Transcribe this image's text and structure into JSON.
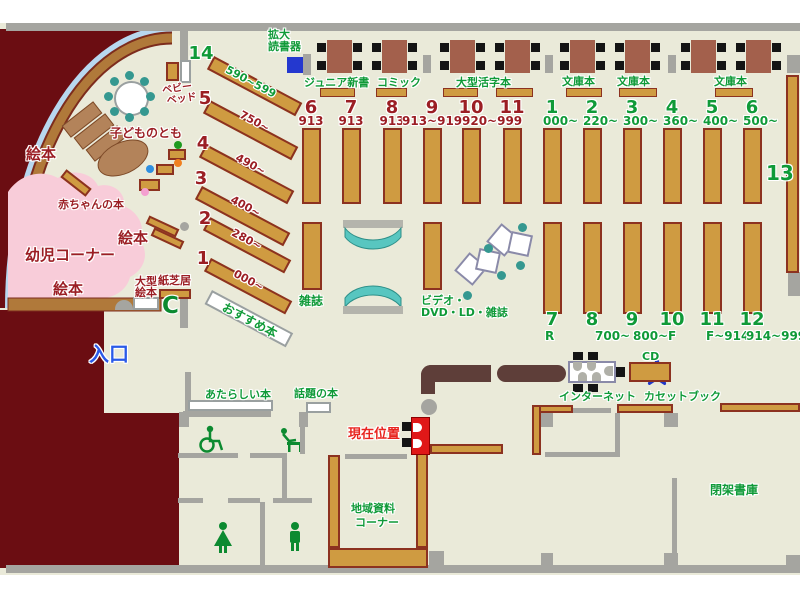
{
  "colors": {
    "floor": "#eaead9",
    "wall": "#a5a5a0",
    "shelf": "#cf9b41",
    "maroon": "#6b0d12",
    "counter": "#5e3e39",
    "table": "#a3604c",
    "teal_bench": "#58c6c0",
    "teal_chair": "#359890",
    "pink_area": "#f8ccd9",
    "green_text": "#0f9a38",
    "darkred_text": "#9b1e24",
    "red_text": "#e8241f",
    "blue_text": "#2a5ae8",
    "device_blue": "#2438cf",
    "star_red": "#ee5555",
    "star_blue": "#2138c8"
  },
  "kids_area": {
    "ehon_left": "絵本",
    "kodomo_no_tomo": "子どものとも",
    "akachan_no_hon": "赤ちゃんの本",
    "ehon_mid": "絵本",
    "yoji_corner": "幼児コーナー",
    "ehon_bottom": "絵本",
    "ogata_ehon_1": "大型",
    "ogata_ehon_2": "絵本",
    "kamishibai": "紙芝居",
    "baby_bed_1": "ベビー",
    "baby_bed_2": "ベッド"
  },
  "entrance": {
    "label": "入口"
  },
  "device": {
    "kakudai_1": "拡大",
    "kakudai_2": "読書器"
  },
  "marker": {
    "label": "現在位置"
  },
  "sections": {
    "junior_shinsho": "ジュニア新書",
    "comic": "コミック",
    "ogata_katsuji": "大型活字本",
    "bunko_1": "文庫本",
    "bunko_2": "文庫本",
    "bunko_3": "文庫本",
    "zasshi": "雑誌",
    "video_1": "ビデオ・",
    "video_2": "DVD・LD・雑誌",
    "osusume": "おすすめ本",
    "wadai": "話題の本",
    "atarashii": "あたらしい本",
    "internet": "インターネット",
    "cd": "CD",
    "cassette": "カセットブック",
    "heika": "閉架書庫",
    "chiiki_1": "地域資料",
    "chiiki_2": "コーナー",
    "shelf13": "13"
  },
  "groups": {
    "diagonal": [
      {
        "num": "14",
        "range": "590~599"
      },
      {
        "num": "5",
        "range": "750~"
      },
      {
        "num": "4",
        "range": "490~"
      },
      {
        "num": "3",
        "range": "400~"
      },
      {
        "num": "2",
        "range": "280~"
      },
      {
        "num": "1",
        "range": "000~"
      }
    ],
    "top_red": [
      {
        "num": "6",
        "range": "913"
      },
      {
        "num": "7",
        "range": "913"
      },
      {
        "num": "8",
        "range": "913"
      },
      {
        "num": "9",
        "range": "913~919"
      },
      {
        "num": "10",
        "range": "920~999"
      },
      {
        "num": "11",
        "range": ""
      }
    ],
    "top_green": [
      {
        "num": "1",
        "range": "000~"
      },
      {
        "num": "2",
        "range": "220~"
      },
      {
        "num": "3",
        "range": "300~"
      },
      {
        "num": "4",
        "range": "360~"
      },
      {
        "num": "5",
        "range": "400~"
      },
      {
        "num": "6",
        "range": "500~"
      }
    ],
    "bottom_green": [
      {
        "num": "7",
        "range": "R"
      },
      {
        "num": "8",
        "range": "700~"
      },
      {
        "num": "9",
        "range": "800~"
      },
      {
        "num": "10",
        "range": "F"
      },
      {
        "num": "11",
        "range": "F~914"
      },
      {
        "num": "12",
        "range": "914~999"
      }
    ]
  }
}
